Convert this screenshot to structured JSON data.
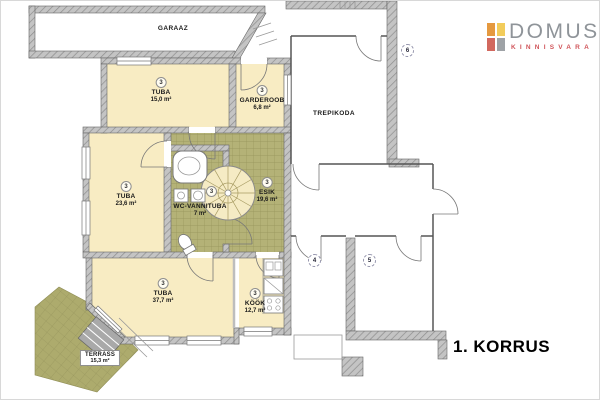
{
  "title": "1. KORRUS",
  "logo": {
    "title": "DOMUS",
    "subtitle": "KINNISVARA",
    "icon_colors": {
      "top_left": "#E5993F",
      "top_right": "#F2CC5B",
      "bottom_left": "#D2685E",
      "bottom_right": "#9EA2A6"
    }
  },
  "rooms": {
    "garaaz": {
      "label": "GARAAZ"
    },
    "tuba_top": {
      "badge": "3",
      "label": "TUBA",
      "area": "15,0 m²"
    },
    "garderoob": {
      "badge": "3",
      "label": "GARDEROOB",
      "area": "6,8 m²"
    },
    "trepikoda": {
      "label": "TREPIKODA"
    },
    "tuba_mid": {
      "badge": "3",
      "label": "TUBA",
      "area": "23,6 m²"
    },
    "wc_vannituba": {
      "badge": "3",
      "label": "WC-VANNITUBA",
      "area": "7 m²"
    },
    "esik": {
      "badge": "3",
      "label": "ESIK",
      "area": "19,6 m²"
    },
    "tuba_bottom": {
      "badge": "3",
      "label": "TUBA",
      "area": "37,7 m²"
    },
    "kook": {
      "badge": "3",
      "label": "KÖÖK",
      "area": "12,7 m²"
    },
    "terrass": {
      "label": "TERRASS",
      "area": "15,3 m²"
    }
  },
  "markers": {
    "stairwell_side": "6",
    "lower_left_room": "4",
    "lower_right_room": "5"
  },
  "colors": {
    "room_fill": "#F8ECC3",
    "tiled_fill": "#B4B277",
    "terrace_fill": "#ADAB6D",
    "wall_fill": "#C4C4C4",
    "wall_hatch": "#8E8E8E",
    "logo_text": "#8F9499",
    "logo_subtext": "#D0555A",
    "floor_text": "#000000"
  }
}
